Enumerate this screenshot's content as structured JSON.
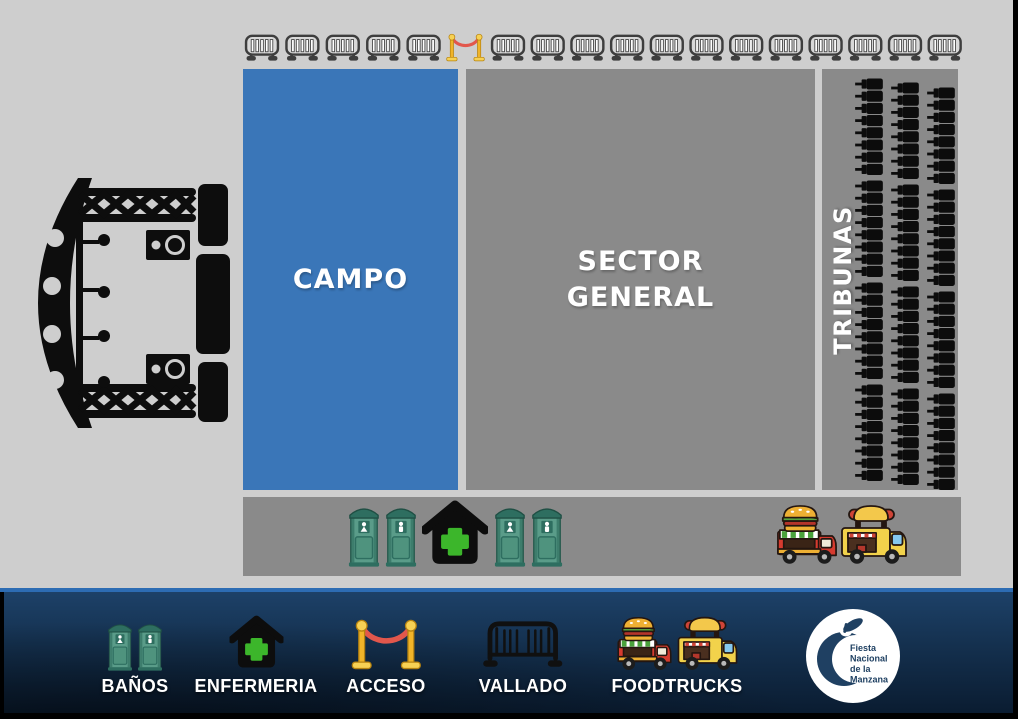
{
  "map": {
    "campo_label": "CAMPO",
    "sector_label_line1": "SECTOR",
    "sector_label_line2": "GENERAL",
    "tribunas_label": "TRIBUNAS",
    "barriers": {
      "left_count": 5,
      "right_count": 12
    },
    "seats": {
      "groups": 4,
      "cols_per_group": 3,
      "rows_per_col": 8
    },
    "facilities": [
      "toilet-female",
      "toilet-male",
      "first-aid",
      "toilet-female",
      "toilet-male",
      "burger-foodtruck",
      "hotdog-foodtruck"
    ]
  },
  "legend": {
    "items": [
      {
        "label": "BAÑOS",
        "icon": "toilets-icon"
      },
      {
        "label": "ENFERMERIA",
        "icon": "first-aid-house-icon"
      },
      {
        "label": "ACCESO",
        "icon": "stanchion-rope-icon"
      },
      {
        "label": "VALLADO",
        "icon": "barrier-fence-icon"
      },
      {
        "label": "FOODTRUCKS",
        "icon": "food-trucks-icon"
      }
    ]
  },
  "logo": {
    "line1": "Fiesta",
    "line2": "Nacional",
    "line3": "de la",
    "line4": "Manzana"
  },
  "colors": {
    "background_gray": "#cecece",
    "panel_gray": "#8a8a8a",
    "campo_blue": "#3a76b8",
    "legend_line_blue": "#2d6cb3",
    "legend_navy_top": "#1d4168",
    "legend_navy_bottom": "#0a1c31",
    "first_aid_green": "#3cb62b",
    "toilet_teal": "#5a9c89",
    "stanchion_yellow": "#f0b429",
    "rope_red": "#e2574c",
    "burger_truck_red": "#d63b2f",
    "hotdog_truck_yellow": "#f2d24b",
    "logo_navy": "#1f4062"
  }
}
